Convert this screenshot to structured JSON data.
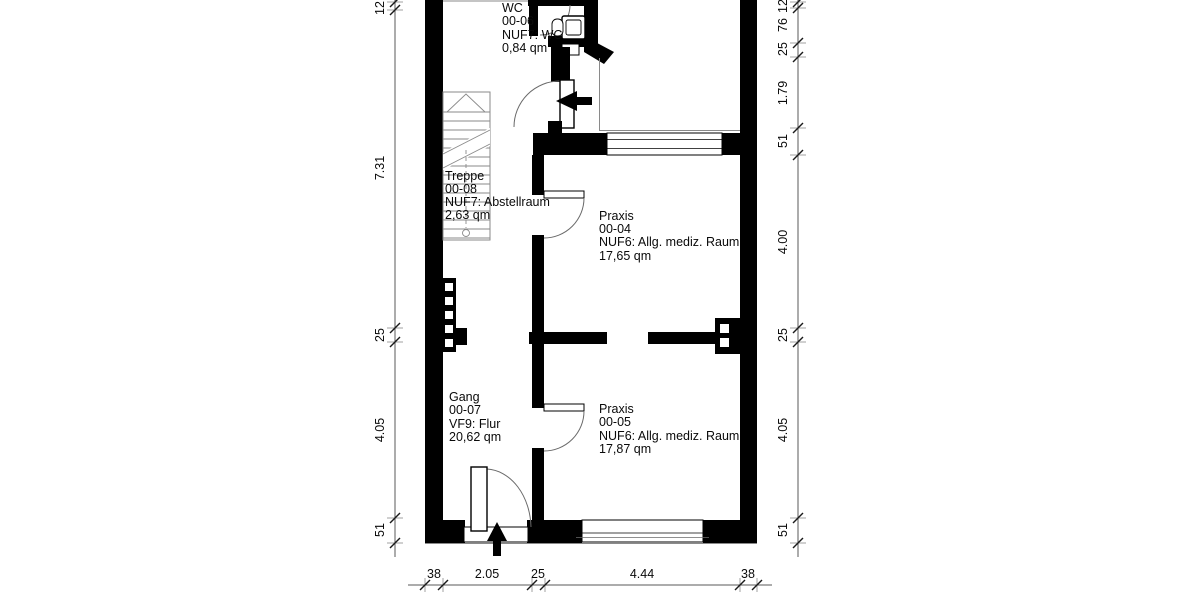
{
  "rooms": {
    "wc": {
      "lines": [
        "WC",
        "00-06",
        "NUF7: WC",
        "0,84 qm"
      ]
    },
    "treppe": {
      "lines": [
        "Treppe",
        "00-08",
        "NUF7: Abstellraum",
        "2,63 qm"
      ]
    },
    "praxis04": {
      "lines": [
        "Praxis",
        "00-04",
        "NUF6: Allg. mediz. Raum",
        "17,65 qm"
      ]
    },
    "gang": {
      "lines": [
        "Gang",
        "00-07",
        "VF9: Flur",
        "20,62 qm"
      ]
    },
    "praxis05": {
      "lines": [
        "Praxis",
        "00-05",
        "NUF6: Allg. mediz. Raum",
        "17,87 qm"
      ]
    }
  },
  "dimensions": {
    "left": [
      "12",
      "7.31",
      "25",
      "4.05",
      "51"
    ],
    "right": [
      "12",
      "76",
      "25",
      "1.79",
      "51",
      "4.00",
      "25",
      "4.05",
      "51"
    ],
    "bottom": [
      "38",
      "2.05",
      "25",
      "4.44",
      "38"
    ]
  },
  "colors": {
    "wall": "#000000",
    "background": "#ffffff",
    "dimension_line": "#5a5a5a",
    "thin_line": "#8a8a8a"
  }
}
